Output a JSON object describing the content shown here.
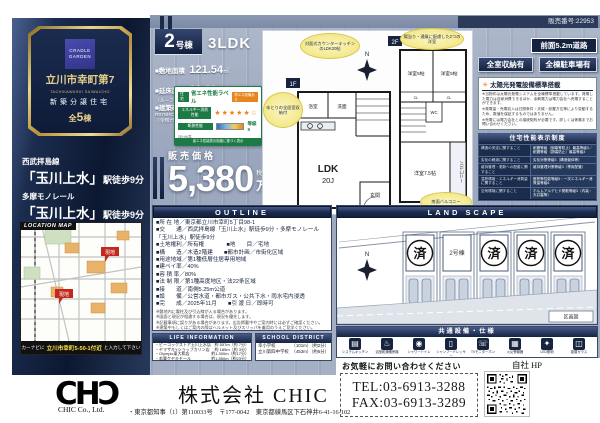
{
  "meta": {
    "sale_no": "販売番号:22953"
  },
  "colors": {
    "navy": "#16243f",
    "gold": "#d8b65e",
    "steel_bg": "#a3aec4",
    "green": "#1e7a45",
    "accent_orange": "#e8861e"
  },
  "sidebar": {
    "emblem": {
      "brand": "CRADLE GARDEN",
      "title": "立川市幸町第7",
      "title_en": "TACHIKAWASHI SAIWAICHO",
      "category": "新築分譲住宅",
      "total_prefix": "全",
      "total_num": "5",
      "total_suffix": "棟"
    },
    "access": [
      {
        "line": "西武拝島線",
        "station": "「玉川上水」",
        "walk": "駅徒歩9分"
      },
      {
        "line": "多摩モノレール",
        "station": "「玉川上水」",
        "walk": "駅徒歩9分"
      }
    ],
    "map_title": "LOCATION MAP",
    "map_site_label": "現地",
    "navi": {
      "prefix": "カーナビに",
      "address": "立川市幸町5-50-1付近",
      "suffix": "と入力して下さい"
    }
  },
  "unit": {
    "no": "2",
    "no_suffix": "号棟",
    "plan": "3LDK",
    "land_label": "■敷地面積",
    "land_value": "121.54",
    "land_unit": "㎡",
    "floor_label": "■延床面積",
    "floor_value": "88.29",
    "floor_unit": "㎡",
    "floor_note": "（ルーフバルコニー面積含む）",
    "confirm_label": "■建築確認番号",
    "confirm_value": "R07SHC123358号",
    "confirm_date": "（令和7年2月10日）",
    "price_label": "販売価格",
    "price": "5,380",
    "price_tax": "税込",
    "price_unit": "万円"
  },
  "energy_label": {
    "tag": "住宅",
    "retag": "再エネ設備あり",
    "title": "省エネ性能ラベル",
    "row1_label": "エネルギー消費性能",
    "row1_stars": "★★★★★☆",
    "row2_label": "断熱性能",
    "row2_value": "等級5",
    "note": "ZEH水準",
    "footer": "省エネ性能表示制度に基づく表示"
  },
  "badges": {
    "road": "前面5.2m道路",
    "storage": "全室収納有",
    "parking": "全棟駐車場有"
  },
  "solar": {
    "title": "太陽光発電設備標準搭載",
    "lines": [
      "※当物件は太陽光発電システムを全棟標準搭載しています。発電した電力は自家消費できるほか、余剰電力は電力会社へ売電することができます。",
      "※発電量・売電収入は日照条件・天候・設置方位等により変動するため、数値を保証するものではありません。",
      "※売電には電力会社との接続契約が必要です。詳しくは係員までお問い合わせください。"
    ]
  },
  "performance": {
    "title": "住宅性能表示制度",
    "rows": [
      {
        "c": "構造の安定に関すること",
        "g": "耐震等級（倒壊等防止）最高等級3／耐震等級（損傷防止）最高等級3"
      },
      {
        "c": "劣化の軽減に関すること",
        "g": "劣化対策等級3（構造躯体等）"
      },
      {
        "c": "維持管理・更新への配慮に関すること",
        "g": "維持管理対策等級3（専用配管）"
      },
      {
        "c": "温熱環境・エネルギー消費量に関すること",
        "g": "断熱等性能等級5・一次エネルギー消費量等級6"
      },
      {
        "c": "空気環境に関すること",
        "g": "ホルムアルデヒド発散等級3（内装・天井裏等）"
      }
    ]
  },
  "floorplan": {
    "f1_tag": "1F",
    "f2_tag": "2F",
    "north": "N",
    "ldk": "LDK",
    "ldk_size": "20J",
    "bath": "浴室",
    "wash": "洗面",
    "entrance": "玄関",
    "wc": "WC",
    "cl": "CL",
    "rooms_2f": [
      "洋室5帖",
      "洋室5帖",
      "洋室7.5帖"
    ],
    "balcony": "バルコニー",
    "callouts": [
      "対面式カウンターキッチンのLDK20帖",
      "陽当り・通風に配慮した2つの洋室",
      "ゆとりの全居室収納付",
      "南面バルコニー"
    ]
  },
  "outline": {
    "title": "OUTLINE",
    "rows": [
      "■所 在 地／東京都立川市幸町5丁目98-1",
      "■交　　通／西武拝島線「玉川上水」駅徒歩9分・多摩モノレール「玉川上水」駅徒歩9分",
      "■土地権利／所有権　　　　■地　　目／宅地",
      "■構　　造／木造2階建　　■都市計画／市街化区域",
      "■用途地域／第1種低層住居専用地域",
      "■建ペイ率／40%",
      "■容 積 率／80%",
      "■法 制 限／第1種高度地区・法22条区域",
      "■接　　道／南側5.25m公道",
      "■設　　備／公営水道・都市ガス・公共下水・雨水宅内浸透",
      "■完　　成／2025年11月　　■引 渡 日／即時可"
    ],
    "notes": [
      "※敷地内に電柱及び引込線が入る場合があります。",
      "※図面と現況が相違する場合は、現況を優先します。",
      "※記載事項に誤りがある場合があります。広告掲載中やご案内時には必ずご確認ください。",
      "※建築中もしくはご案内の際はヘルメット及びスリッパを着用のうえご見学ください。"
    ]
  },
  "landscape": {
    "title": "LAND SCAPE",
    "legend": "区画図",
    "lots": [
      {
        "mark": "済"
      },
      {
        "mark": "2号棟"
      },
      {
        "mark": "済"
      },
      {
        "mark": "済"
      },
      {
        "mark": "済"
      }
    ]
  },
  "life": {
    "title": "LIFE INFORMATION",
    "items": [
      {
        "name": "・ピーコックストア玉川上水店",
        "dist": "約 557m（約 7分）"
      },
      {
        "name": "・ヤマザキYショップカリン店",
        "dist": "約 185m（約 3分）"
      },
      {
        "name": "・Olympic東大和店",
        "dist": "約1,300m（約17分）"
      },
      {
        "name": "・若葉ケヤキモール",
        "dist": "約1,850m（約23分）"
      }
    ]
  },
  "school": {
    "title": "SCHOOL DISTRICT",
    "items": [
      {
        "name": "幸小学校",
        "dist": "（101m）（約2分）"
      },
      {
        "name": "立川第四中学校",
        "dist": "（453m）（約6分）"
      }
    ]
  },
  "facilities": {
    "title": "共通設備・仕様",
    "items": [
      {
        "label": "システムキッチン"
      },
      {
        "label": "浴室乾燥暖房機"
      },
      {
        "label": "シャワートイレ"
      },
      {
        "label": "シャンプードレッサー"
      },
      {
        "label": "TVモニターホン"
      },
      {
        "label": "火災警報器"
      },
      {
        "label": "LED照明"
      },
      {
        "label": "複層ガラス"
      }
    ]
  },
  "contact": {
    "cta": "お気軽にお問い合わせください",
    "hp": "自社 HP",
    "tel": "TEL:03-6913-3288",
    "fax": "FAX:03-6913-3289"
  },
  "footer": {
    "logo": "CHƆ",
    "logo_sub": "CHIC Co., Ltd.",
    "company": "株式会社 CHIC",
    "license": "・東京都知事（1）第110033号　〒177-0042　東京都練馬区下石神井6-41-16-102"
  }
}
